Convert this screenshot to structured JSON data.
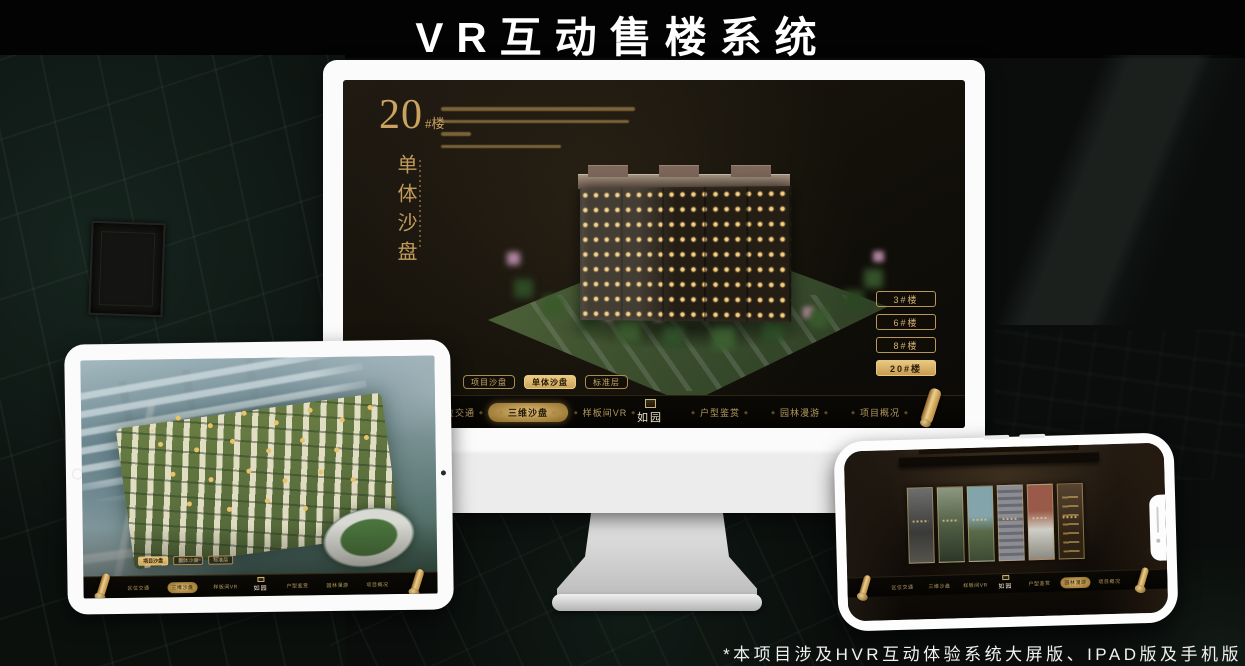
{
  "page": {
    "title": "VR互动售楼系统",
    "footnote": "*本项目涉及HVR互动体验系统大屏版、IPAD版及手机版"
  },
  "colors": {
    "gold": "#c9a35f",
    "gold_bright": "#e9c77f",
    "gold_fill": "#d8b469",
    "screen_bg": "#171209",
    "marker_gold": "#e8c36a"
  },
  "monitor_screen": {
    "heading": {
      "number": "20",
      "suffix": "#楼",
      "category": "单体沙盘"
    },
    "floor_buttons": [
      {
        "label": "3#楼",
        "active": false
      },
      {
        "label": "6#楼",
        "active": false
      },
      {
        "label": "8#楼",
        "active": false
      },
      {
        "label": "20#楼",
        "active": true
      }
    ],
    "sub_tabs": [
      {
        "label": "项目沙盘",
        "active": false
      },
      {
        "label": "单体沙盘",
        "active": true
      },
      {
        "label": "标准层",
        "active": false
      }
    ],
    "nav": {
      "logo": "如园",
      "items": [
        {
          "label": "区位交通",
          "active": false
        },
        {
          "label": "三维沙盘",
          "active": true
        },
        {
          "label": "样板间VR",
          "active": false
        },
        {
          "label": "户型鉴赏",
          "active": false
        },
        {
          "label": "园林漫游",
          "active": false
        },
        {
          "label": "项目概况",
          "active": false
        }
      ]
    }
  },
  "tablet_screen": {
    "sub_tabs": [
      {
        "label": "项目沙盘",
        "active": true
      },
      {
        "label": "单体沙盘",
        "active": false
      },
      {
        "label": "标准层",
        "active": false
      }
    ],
    "nav": {
      "logo": "如园",
      "items": [
        {
          "label": "区位交通",
          "active": false
        },
        {
          "label": "三维沙盘",
          "active": true
        },
        {
          "label": "样板间VR",
          "active": false
        },
        {
          "label": "户型鉴赏",
          "active": false
        },
        {
          "label": "园林漫游",
          "active": false
        },
        {
          "label": "项目概况",
          "active": false
        }
      ]
    }
  },
  "phone_screen": {
    "nav": {
      "logo": "如园",
      "items": [
        {
          "label": "区位交通",
          "active": false
        },
        {
          "label": "三维沙盘",
          "active": false
        },
        {
          "label": "样板间VR",
          "active": false
        },
        {
          "label": "户型鉴赏",
          "active": false
        },
        {
          "label": "园林漫游",
          "active": true
        },
        {
          "label": "项目概况",
          "active": false
        }
      ]
    }
  }
}
